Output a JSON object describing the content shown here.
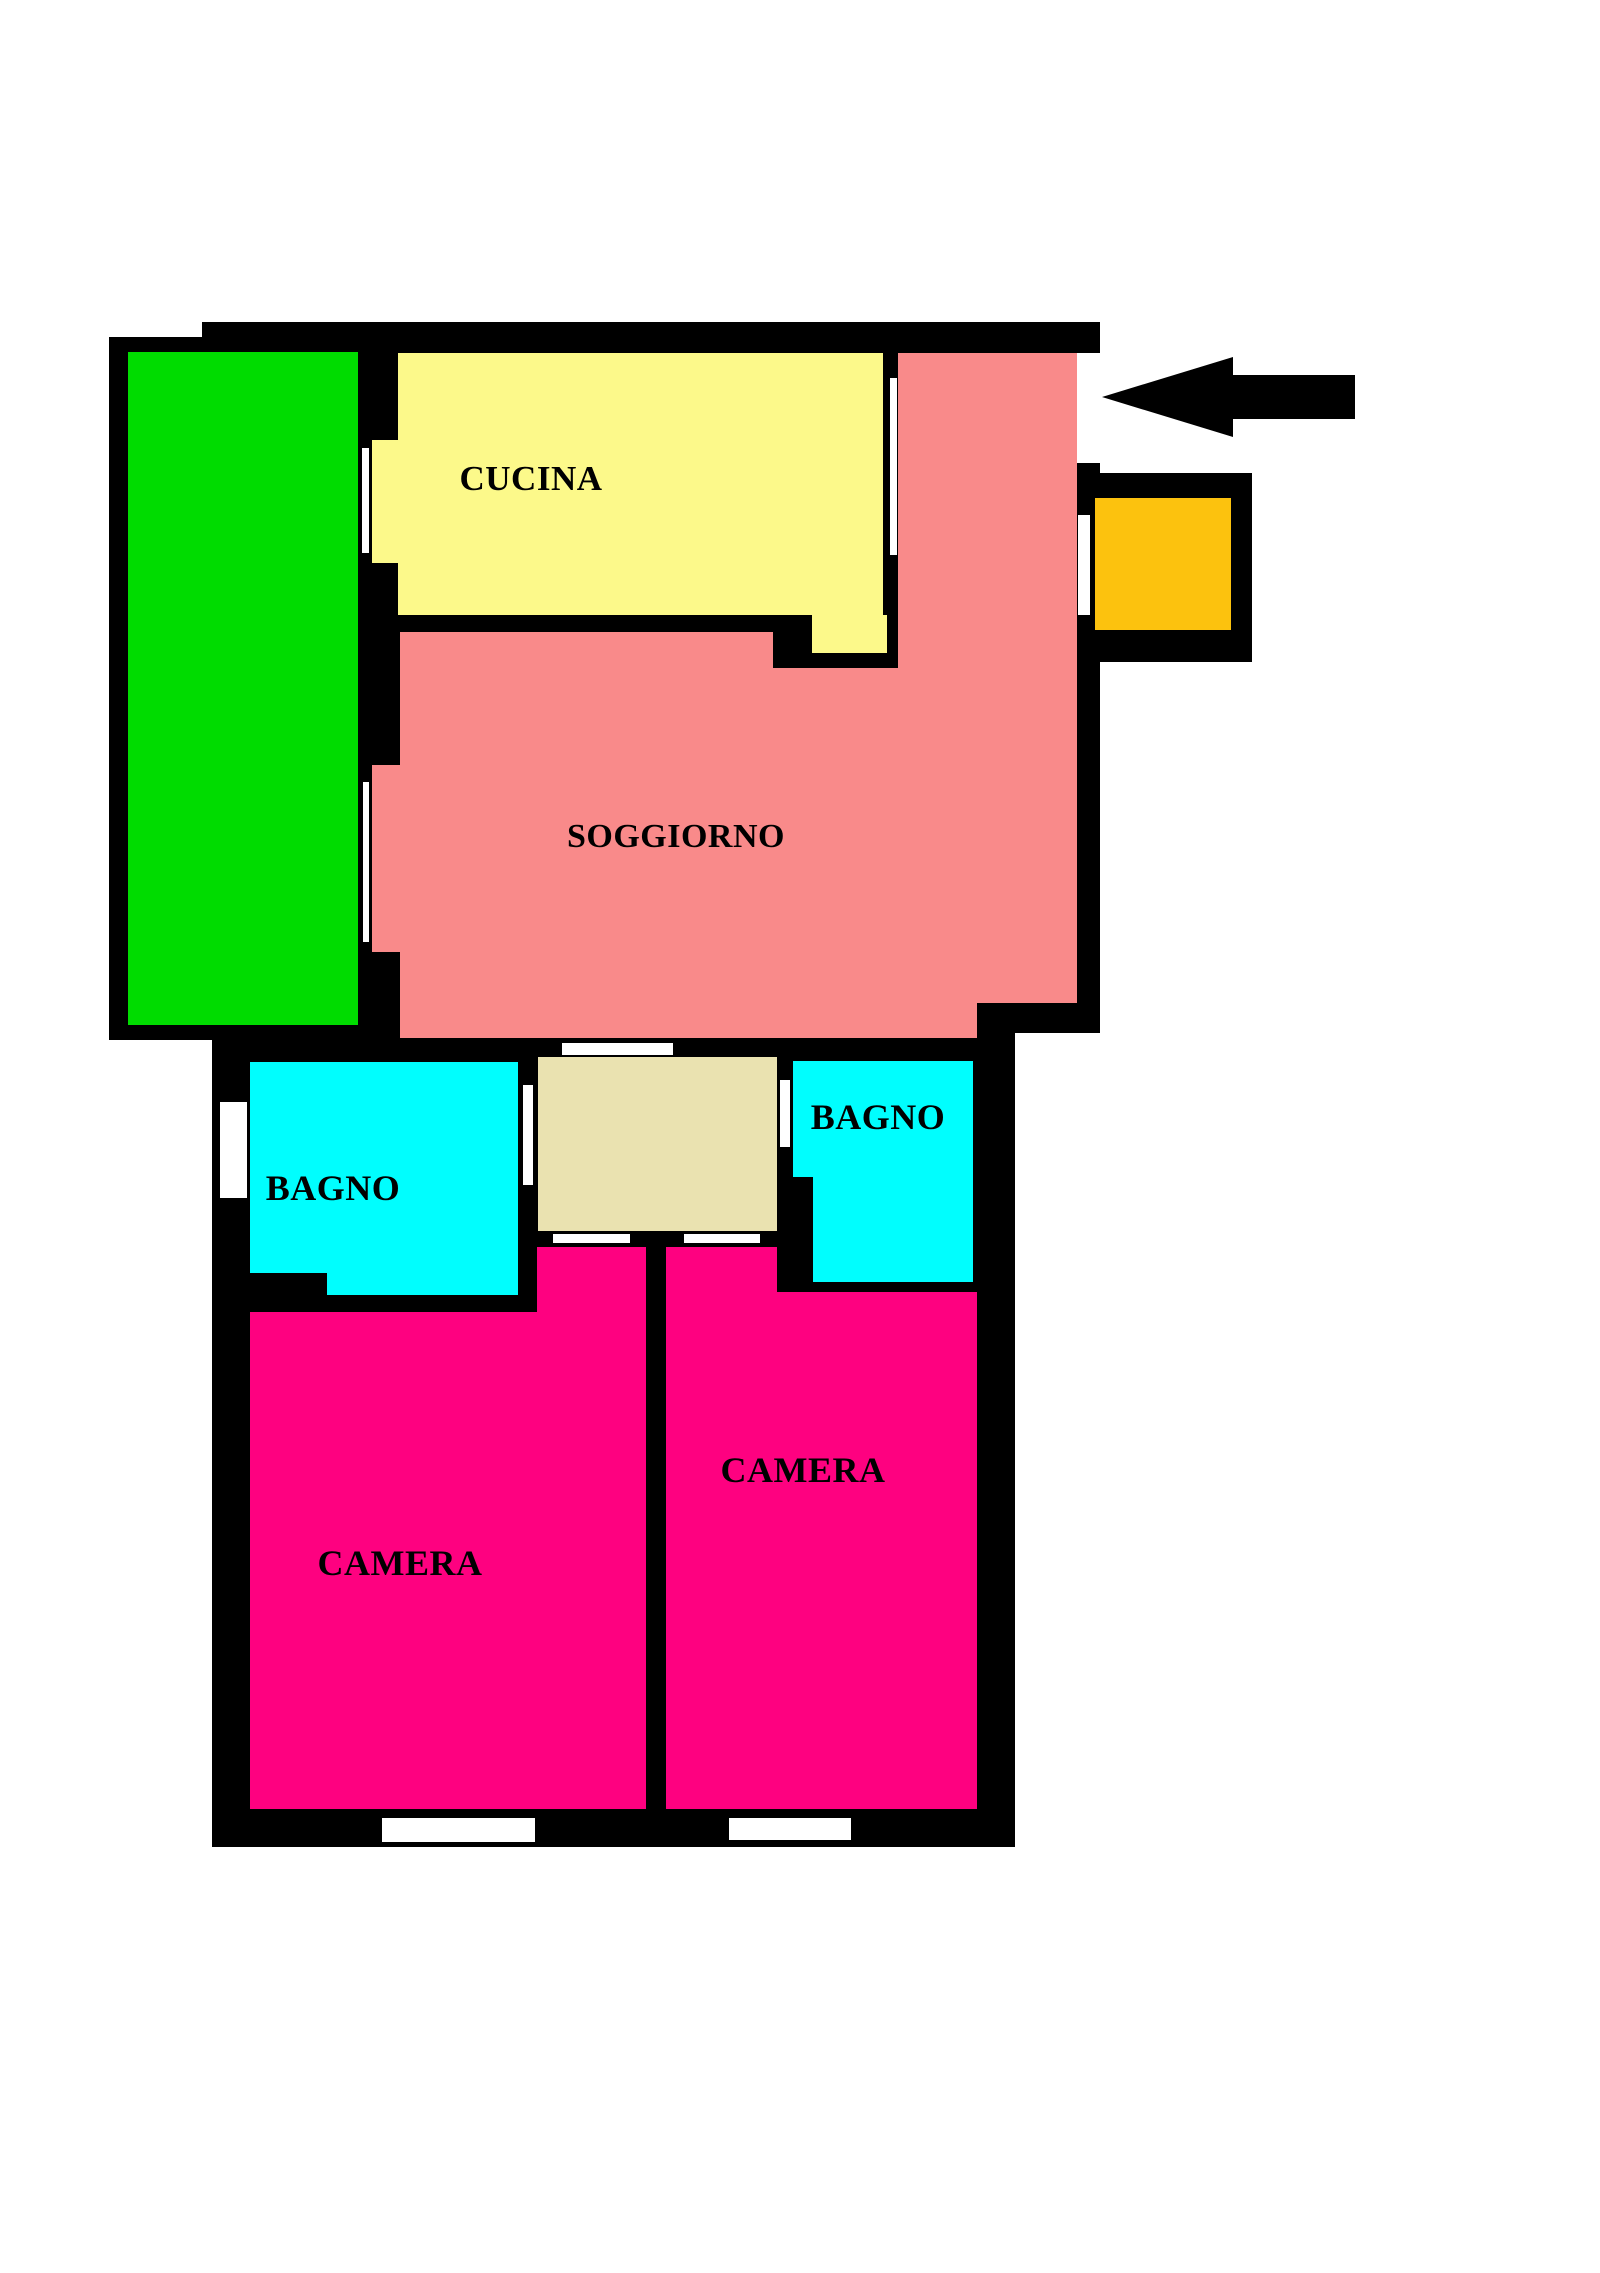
{
  "title": "Apartment floor plan",
  "colors": {
    "wall": "#000000",
    "background": "#ffffff",
    "balcony_green": "#00DC00",
    "kitchen_yellow": "#FCF98A",
    "living_salmon": "#F98A8A",
    "balcony_orange": "#FCC20E",
    "bath_cyan": "#00FEFE",
    "bedroom_magenta": "#FE0180",
    "hall_beige": "#EAE2B0",
    "arrow_black": "#000000"
  },
  "plan": {
    "canvas": {
      "width": 1600,
      "height": 2273
    },
    "walls": [
      {
        "name": "outer-wall-upper-block",
        "x": 109,
        "y": 322,
        "w": 991,
        "h": 711
      },
      {
        "name": "outer-wall-left-sliver",
        "x": 109,
        "y": 1033,
        "w": 103,
        "h": 7
      },
      {
        "name": "outer-wall-lower-block",
        "x": 212,
        "y": 1033,
        "w": 803,
        "h": 814
      },
      {
        "name": "orange-balcony-frame",
        "x": 1087,
        "y": 473,
        "w": 165,
        "h": 189
      }
    ],
    "wall_carves": [
      {
        "name": "top-left-wall-step",
        "x": 109,
        "y": 322,
        "w": 93,
        "h": 15
      }
    ],
    "rooms": [
      {
        "name": "balcony-green",
        "color": "balcony_green",
        "rects": [
          [
            128,
            352,
            230,
            673
          ]
        ]
      },
      {
        "name": "kitchen",
        "color": "kitchen_yellow",
        "rects": [
          [
            398,
            353,
            485,
            262
          ],
          [
            372,
            440,
            26,
            123
          ],
          [
            812,
            615,
            75,
            38
          ]
        ]
      },
      {
        "name": "living-room",
        "color": "living_salmon",
        "rects": [
          [
            400,
            632,
            373,
            406
          ],
          [
            773,
            668,
            125,
            370
          ],
          [
            898,
            353,
            79,
            685
          ],
          [
            977,
            353,
            100,
            650
          ],
          [
            372,
            765,
            30,
            187
          ]
        ]
      },
      {
        "name": "balcony-orange",
        "color": "balcony_orange",
        "rects": [
          [
            1095,
            498,
            136,
            132
          ]
        ]
      },
      {
        "name": "hallway",
        "color": "hall_beige",
        "rects": [
          [
            538,
            1057,
            239,
            174
          ]
        ]
      },
      {
        "name": "bathroom-left",
        "color": "bath_cyan",
        "rects": [
          [
            250,
            1062,
            268,
            211
          ],
          [
            327,
            1273,
            191,
            22
          ]
        ]
      },
      {
        "name": "bathroom-right",
        "color": "bath_cyan",
        "rects": [
          [
            793,
            1061,
            180,
            116
          ],
          [
            813,
            1177,
            160,
            105
          ]
        ]
      },
      {
        "name": "bedroom-left",
        "color": "bedroom_magenta",
        "rects": [
          [
            250,
            1312,
            396,
            497
          ],
          [
            537,
            1247,
            109,
            65
          ]
        ]
      },
      {
        "name": "bedroom-right",
        "color": "bedroom_magenta",
        "rects": [
          [
            666,
            1292,
            311,
            517
          ],
          [
            666,
            1247,
            111,
            45
          ]
        ]
      }
    ],
    "openings": [
      {
        "name": "window-balcony-kitchen",
        "x": 362,
        "y": 448,
        "w": 7,
        "h": 105
      },
      {
        "name": "door-kitchen-living",
        "x": 890,
        "y": 378,
        "w": 7,
        "h": 177
      },
      {
        "name": "entrance-opening",
        "x": 1077,
        "y": 353,
        "w": 23,
        "h": 110
      },
      {
        "name": "window-living-orange-balcony",
        "x": 1078,
        "y": 515,
        "w": 12,
        "h": 100
      },
      {
        "name": "window-living-green-balcony",
        "x": 363,
        "y": 782,
        "w": 6,
        "h": 160
      },
      {
        "name": "door-living-hallway",
        "x": 562,
        "y": 1043,
        "w": 111,
        "h": 12
      },
      {
        "name": "window-bathroom-left",
        "x": 220,
        "y": 1102,
        "w": 27,
        "h": 96
      },
      {
        "name": "door-hallway-bathroom-left",
        "x": 523,
        "y": 1085,
        "w": 10,
        "h": 100
      },
      {
        "name": "door-hallway-bathroom-right",
        "x": 780,
        "y": 1080,
        "w": 10,
        "h": 67
      },
      {
        "name": "door-hallway-bedroom-left",
        "x": 553,
        "y": 1234,
        "w": 77,
        "h": 9
      },
      {
        "name": "door-hallway-bedroom-right",
        "x": 684,
        "y": 1234,
        "w": 76,
        "h": 9
      },
      {
        "name": "window-bedroom-left-bottom",
        "x": 382,
        "y": 1818,
        "w": 153,
        "h": 24
      },
      {
        "name": "window-bedroom-right-bottom",
        "x": 729,
        "y": 1818,
        "w": 122,
        "h": 22
      }
    ],
    "labels": [
      {
        "name": "kitchen-label",
        "text": "CUCINA",
        "x": 531,
        "y": 479,
        "size": 35
      },
      {
        "name": "living-room-label",
        "text": "SOGGIORNO",
        "x": 676,
        "y": 837,
        "size": 34
      },
      {
        "name": "bathroom-left-label",
        "text": "BAGNO",
        "x": 333,
        "y": 1188,
        "size": 36
      },
      {
        "name": "bathroom-right-label",
        "text": "BAGNO",
        "x": 878,
        "y": 1117,
        "size": 36
      },
      {
        "name": "bedroom-left-label",
        "text": "CAMERA",
        "x": 400,
        "y": 1563,
        "size": 36
      },
      {
        "name": "bedroom-right-label",
        "text": "CAMERA",
        "x": 803,
        "y": 1470,
        "size": 36
      }
    ],
    "entrance_arrow": {
      "name": "entrance-arrow",
      "tip_x": 1102,
      "tip_y": 397,
      "head_width": 131,
      "head_half_height": 40,
      "shaft_x": 1233,
      "shaft_y": 375,
      "shaft_w": 122,
      "shaft_h": 44
    }
  }
}
